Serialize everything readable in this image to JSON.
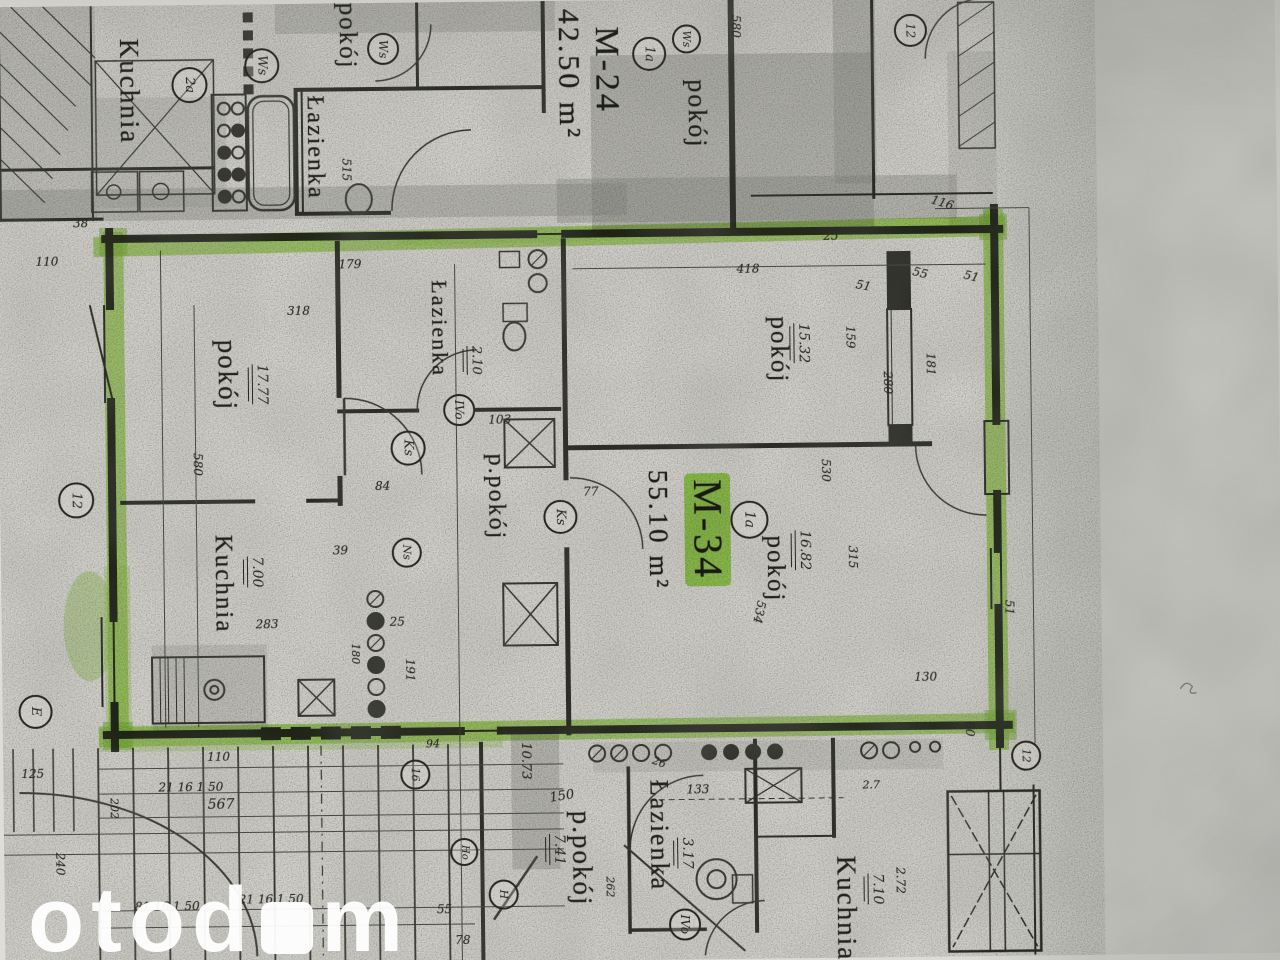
{
  "plan": {
    "highlight_color": "#8ac63c",
    "ink_color": "#26261f",
    "watermark": {
      "prefix": "otod",
      "suffix": "m"
    },
    "units": [
      {
        "id": "M-24",
        "area": "42.50 m²"
      },
      {
        "id": "M-34",
        "area": "55.10 m²",
        "highlighted": true
      }
    ],
    "labels": [
      {
        "text": "Kuchnia",
        "x": 120,
        "y": 33,
        "fs": 27,
        "name": "room-label-kuchnia-m24"
      },
      {
        "text": "Łazienka",
        "x": 307,
        "y": 92,
        "fs": 24,
        "name": "room-label-lazienka-m24"
      },
      {
        "text": "P.pokój",
        "x": 340,
        "y": -22,
        "fs": 25,
        "name": "room-label-ppokoj-m24"
      },
      {
        "text": "M-24",
        "x": 594,
        "y": 26,
        "fs": 34,
        "name": "unit-label-m24",
        "unit": true
      },
      {
        "text": "42.50 m²",
        "x": 558,
        "y": 8,
        "fs": 30,
        "name": "unit-area-m24",
        "unit": true
      },
      {
        "text": "pokój",
        "x": 688,
        "y": 80,
        "fs": 26,
        "name": "room-label-pokoj-m24"
      },
      {
        "text": "pokój",
        "x": 215,
        "y": 335,
        "fs": 27,
        "name": "room-label-pokoj-m34-west"
      },
      {
        "text": "Łazienka",
        "x": 430,
        "y": 278,
        "fs": 22,
        "name": "room-label-lazienka-m34"
      },
      {
        "text": "p.pokój",
        "x": 484,
        "y": 452,
        "fs": 24,
        "name": "room-label-ppokoj-m34"
      },
      {
        "text": "Kuchnia",
        "x": 210,
        "y": 530,
        "fs": 25,
        "name": "room-label-kuchnia-m34"
      },
      {
        "text": "pokój",
        "x": 768,
        "y": 318,
        "fs": 25,
        "name": "room-label-pokoj-m34-ne"
      },
      {
        "text": "pokój",
        "x": 762,
        "y": 537,
        "fs": 25,
        "name": "room-label-pokoj-m34-se"
      },
      {
        "text": "M-34",
        "x": 684,
        "y": 474,
        "fs": 40,
        "name": "unit-label-m34",
        "unit": true,
        "hl": true
      },
      {
        "text": "55.10 m²",
        "x": 644,
        "y": 470,
        "fs": 27,
        "name": "unit-area-m34",
        "unit": true
      },
      {
        "text": "Łazienka",
        "x": 642,
        "y": 780,
        "fs": 26,
        "name": "room-label-lazienka-south"
      },
      {
        "text": "p.pokój",
        "x": 564,
        "y": 810,
        "fs": 27,
        "name": "room-label-ppokoj-south"
      },
      {
        "text": "Kuchnia",
        "x": 828,
        "y": 858,
        "fs": 27,
        "name": "room-label-kuchnia-south"
      }
    ],
    "areas": [
      {
        "text": "17.77",
        "x": 253,
        "y": 360,
        "fs": 14
      },
      {
        "text": "15.32",
        "x": 795,
        "y": 325,
        "fs": 14
      },
      {
        "text": "16.82",
        "x": 794,
        "y": 532,
        "fs": 14
      },
      {
        "text": "7.00",
        "x": 246,
        "y": 552,
        "fs": 14
      },
      {
        "text": "2.10",
        "x": 468,
        "y": 344,
        "fs": 13
      },
      {
        "text": "3.17",
        "x": 673,
        "y": 838,
        "fs": 14
      },
      {
        "text": "7.41",
        "x": 545,
        "y": 833,
        "fs": 14
      },
      {
        "text": "7.10",
        "x": 863,
        "y": 876,
        "fs": 14
      }
    ],
    "markers": [
      {
        "text": "2a",
        "x": 176,
        "y": 62,
        "d": 32
      },
      {
        "text": "Ws",
        "x": 249,
        "y": 44,
        "d": 31
      },
      {
        "text": "Ws",
        "x": 372,
        "y": 30,
        "d": 28
      },
      {
        "text": "1a",
        "x": 637,
        "y": 37,
        "d": 30
      },
      {
        "text": "Ws",
        "x": 677,
        "y": 25,
        "d": 25
      },
      {
        "text": "12",
        "x": 899,
        "y": 17,
        "d": 29
      },
      {
        "text": "1a",
        "x": 730,
        "y": 502,
        "d": 34
      },
      {
        "text": "Ks",
        "x": 391,
        "y": 428,
        "d": 31
      },
      {
        "text": "IVo",
        "x": 444,
        "y": 392,
        "d": 28
      },
      {
        "text": "Ks",
        "x": 543,
        "y": 499,
        "d": 30
      },
      {
        "text": "Ns",
        "x": 391,
        "y": 535,
        "d": 26
      },
      {
        "text": "12",
        "x": 58,
        "y": 476,
        "d": 32
      },
      {
        "text": "E",
        "x": 16,
        "y": 688,
        "d": 30
      },
      {
        "text": "12",
        "x": 1008,
        "y": 745,
        "d": 26
      },
      {
        "text": "16",
        "x": 397,
        "y": 757,
        "d": 26
      },
      {
        "text": "Ho",
        "x": 446,
        "y": 836,
        "d": 24
      },
      {
        "text": "H",
        "x": 484,
        "y": 878,
        "d": 26
      },
      {
        "text": "IVo",
        "x": 664,
        "y": 909,
        "d": 28
      }
    ],
    "dimensions": [
      {
        "text": "515",
        "x": 344,
        "y": 155,
        "o": "v"
      },
      {
        "text": "38",
        "x": 76,
        "y": 211,
        "o": "h"
      },
      {
        "text": "110",
        "x": 38,
        "y": 249,
        "o": "h"
      },
      {
        "text": "580",
        "x": 735,
        "y": 16,
        "o": "v"
      },
      {
        "text": "116",
        "x": 934,
        "y": 200,
        "o": "h",
        "rot": 18
      },
      {
        "text": "25",
        "x": 826,
        "y": 232,
        "o": "h"
      },
      {
        "text": "55",
        "x": 915,
        "y": 270,
        "o": "h",
        "rot": 15
      },
      {
        "text": "51",
        "x": 966,
        "y": 274,
        "o": "h",
        "rot": 15
      },
      {
        "text": "418",
        "x": 739,
        "y": 264,
        "o": "h"
      },
      {
        "text": "179",
        "x": 341,
        "y": 255,
        "o": "h"
      },
      {
        "text": "318",
        "x": 289,
        "y": 301,
        "o": "h"
      },
      {
        "text": "51",
        "x": 858,
        "y": 282,
        "o": "h",
        "rot": 12
      },
      {
        "text": "159",
        "x": 846,
        "y": 328,
        "o": "v"
      },
      {
        "text": "181",
        "x": 926,
        "y": 356,
        "o": "v"
      },
      {
        "text": "280",
        "x": 883,
        "y": 374,
        "o": "v"
      },
      {
        "text": "530",
        "x": 820,
        "y": 461,
        "o": "v"
      },
      {
        "text": "315",
        "x": 846,
        "y": 548,
        "o": "v"
      },
      {
        "text": "534",
        "x": 752,
        "y": 602,
        "o": "v",
        "rot": 12
      },
      {
        "text": "580",
        "x": 192,
        "y": 448,
        "o": "v"
      },
      {
        "text": "103",
        "x": 489,
        "y": 412,
        "o": "h"
      },
      {
        "text": "84",
        "x": 375,
        "y": 477,
        "o": "h"
      },
      {
        "text": "77",
        "x": 583,
        "y": 485,
        "o": "h"
      },
      {
        "text": "39",
        "x": 332,
        "y": 541,
        "o": "h"
      },
      {
        "text": "25",
        "x": 388,
        "y": 613,
        "o": "h"
      },
      {
        "text": "283",
        "x": 254,
        "y": 614,
        "o": "h"
      },
      {
        "text": "191",
        "x": 402,
        "y": 656,
        "o": "v"
      },
      {
        "text": "180",
        "x": 348,
        "y": 640,
        "o": "v",
        "fs": 11
      },
      {
        "text": "60",
        "x": 961,
        "y": 725,
        "o": "v"
      },
      {
        "text": "51",
        "x": 1002,
        "y": 604,
        "o": "v"
      },
      {
        "text": "130",
        "x": 912,
        "y": 674,
        "o": "h"
      },
      {
        "text": "2.72",
        "x": 890,
        "y": 870,
        "o": "v"
      },
      {
        "text": "262",
        "x": 600,
        "y": 876,
        "o": "v",
        "fs": 11
      },
      {
        "text": "2.7",
        "x": 859,
        "y": 782,
        "o": "h",
        "fs": 11
      },
      {
        "text": "133",
        "x": 683,
        "y": 784,
        "o": "h"
      },
      {
        "text": "26",
        "x": 649,
        "y": 757,
        "o": "h",
        "rot": 20,
        "fs": 11
      },
      {
        "text": "10.73",
        "x": 516,
        "y": 741,
        "o": "v",
        "fs": 13
      },
      {
        "text": "150",
        "x": 546,
        "y": 789,
        "o": "h",
        "rot": -8,
        "fs": 13
      },
      {
        "text": "94",
        "x": 423,
        "y": 736,
        "o": "h",
        "fs": 11
      },
      {
        "text": "110",
        "x": 204,
        "y": 746,
        "o": "h"
      },
      {
        "text": "125",
        "x": 18,
        "y": 761,
        "o": "h"
      },
      {
        "text": "21 16 1 50",
        "x": 155,
        "y": 776,
        "o": "h"
      },
      {
        "text": "567",
        "x": 204,
        "y": 793,
        "o": "h",
        "fs": 14
      },
      {
        "text": "81 16 1 50",
        "x": 130,
        "y": 895,
        "o": "h"
      },
      {
        "text": "21 16 1 50",
        "x": 234,
        "y": 889,
        "o": "h"
      },
      {
        "text": "55",
        "x": 432,
        "y": 901,
        "o": "h"
      },
      {
        "text": "78",
        "x": 450,
        "y": 932,
        "o": "h"
      },
      {
        "text": "240",
        "x": 50,
        "y": 846,
        "o": "v"
      },
      {
        "text": "202",
        "x": 105,
        "y": 792,
        "o": "v",
        "fs": 11
      }
    ]
  }
}
